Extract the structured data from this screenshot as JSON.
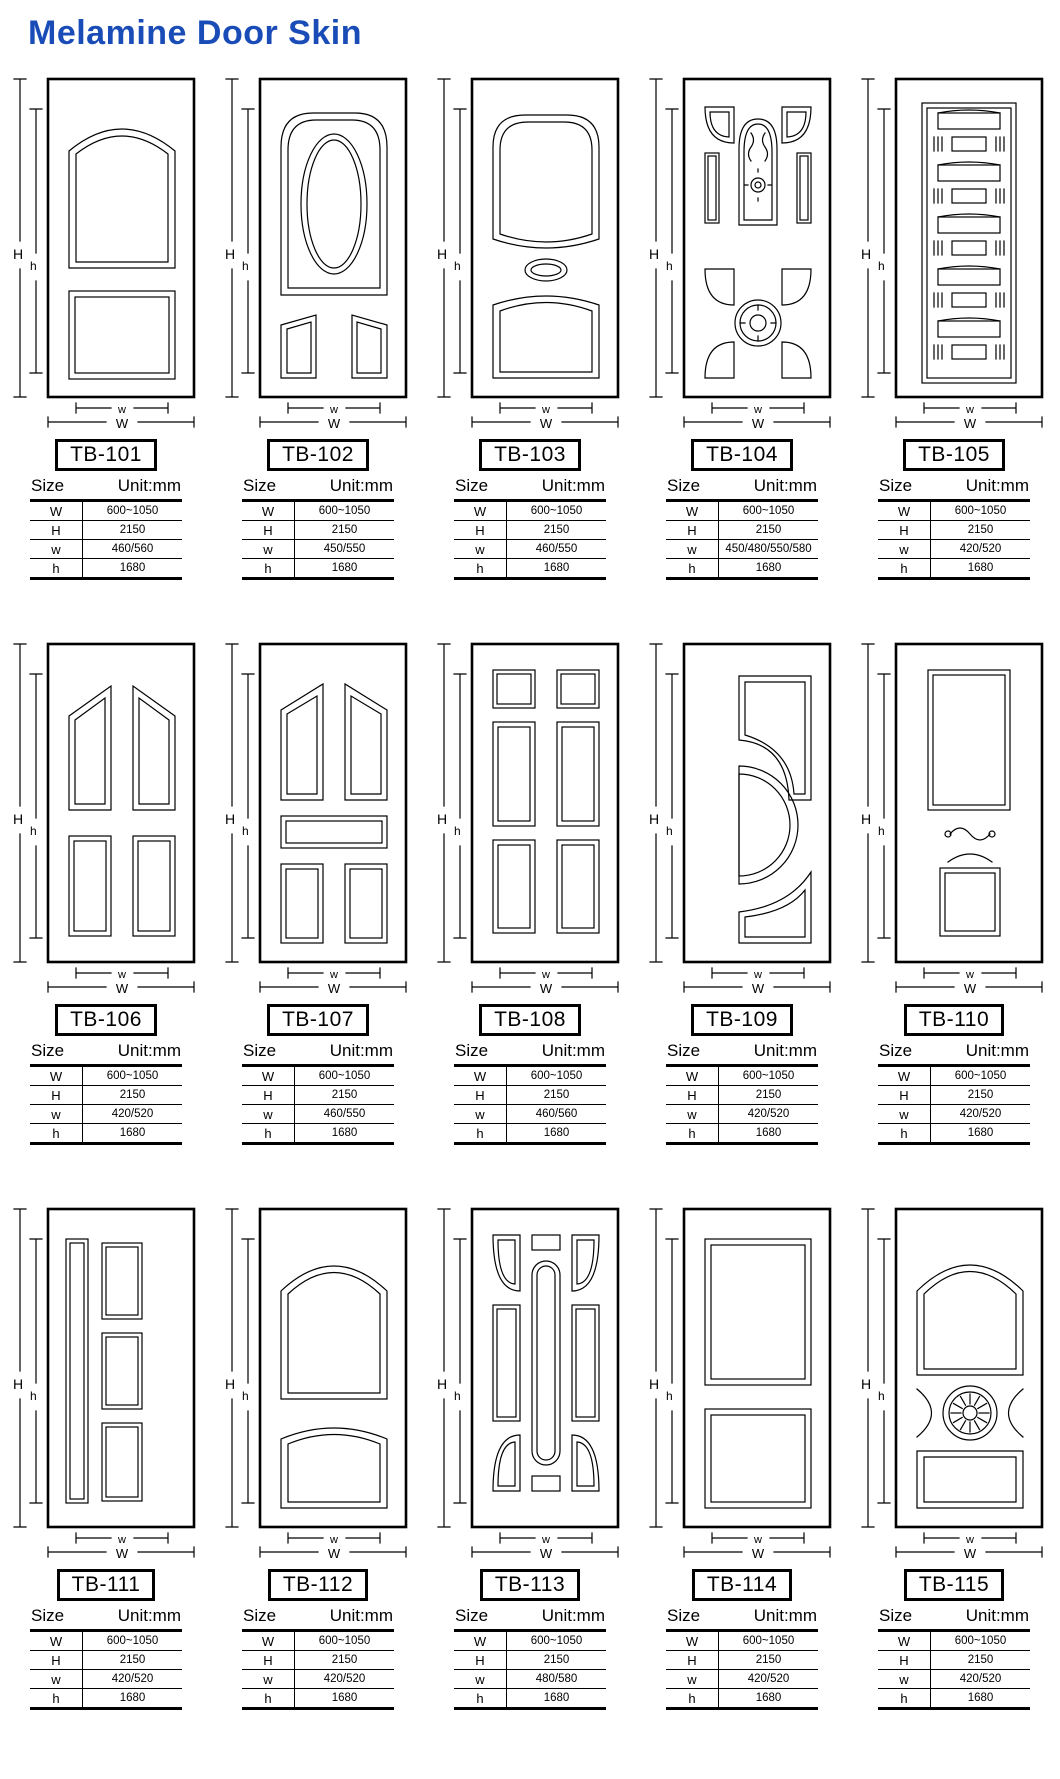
{
  "page": {
    "title": "Melamine Door Skin",
    "title_color": "#1a4cb8",
    "line_color": "#000000",
    "background": "#ffffff"
  },
  "dimension_labels": {
    "outer_height": "H",
    "inner_height": "h",
    "outer_width": "W",
    "inner_width": "w"
  },
  "table": {
    "size_label": "Size",
    "unit_label": "Unit:mm",
    "row_labels": [
      "W",
      "H",
      "w",
      "h"
    ]
  },
  "doors": [
    {
      "code": "TB-101",
      "design": "arched-two-panel",
      "values": [
        "600~1050",
        "2150",
        "460/560",
        "1680"
      ]
    },
    {
      "code": "TB-102",
      "design": "oval-three-panel",
      "values": [
        "600~1050",
        "2150",
        "450/550",
        "1680"
      ]
    },
    {
      "code": "TB-103",
      "design": "arch-oval-two-panel",
      "values": [
        "600~1050",
        "2150",
        "460/550",
        "1680"
      ]
    },
    {
      "code": "TB-104",
      "design": "ornate-carved",
      "values": [
        "600~1050",
        "2150",
        "450/480/550/580",
        "1680"
      ]
    },
    {
      "code": "TB-105",
      "design": "stacked-blocks",
      "values": [
        "600~1050",
        "2150",
        "420/520",
        "1680"
      ]
    },
    {
      "code": "TB-106",
      "design": "four-panel-peaked",
      "values": [
        "600~1050",
        "2150",
        "420/520",
        "1680"
      ]
    },
    {
      "code": "TB-107",
      "design": "five-panel-peaked",
      "values": [
        "600~1050",
        "2150",
        "460/550",
        "1680"
      ]
    },
    {
      "code": "TB-108",
      "design": "six-panel",
      "values": [
        "600~1050",
        "2150",
        "460/560",
        "1680"
      ]
    },
    {
      "code": "TB-109",
      "design": "crescent-modern",
      "values": [
        "600~1050",
        "2150",
        "420/520",
        "1680"
      ]
    },
    {
      "code": "TB-110",
      "design": "panel-ornament-square",
      "values": [
        "600~1050",
        "2150",
        "420/520",
        "1680"
      ]
    },
    {
      "code": "TB-111",
      "design": "strip-three-stack",
      "values": [
        "600~1050",
        "2150",
        "420/520",
        "1680"
      ]
    },
    {
      "code": "TB-112",
      "design": "double-arch-panel",
      "values": [
        "600~1050",
        "2150",
        "420/520",
        "1680"
      ]
    },
    {
      "code": "TB-113",
      "design": "pill-multi-panel",
      "values": [
        "600~1050",
        "2150",
        "480/580",
        "1680"
      ]
    },
    {
      "code": "TB-114",
      "design": "two-flat-panel",
      "values": [
        "600~1050",
        "2150",
        "420/520",
        "1680"
      ]
    },
    {
      "code": "TB-115",
      "design": "arch-rosette-panel",
      "values": [
        "600~1050",
        "2150",
        "420/520",
        "1680"
      ]
    }
  ]
}
